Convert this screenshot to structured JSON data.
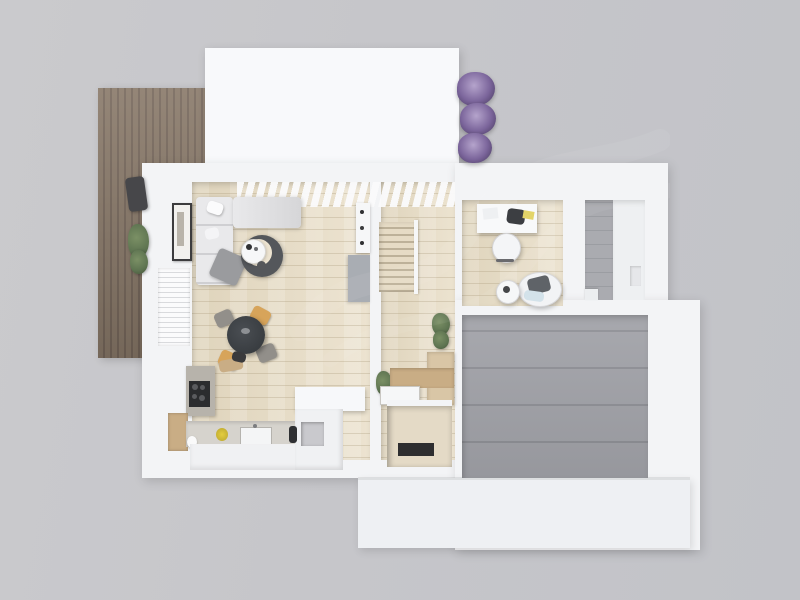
{
  "scene": {
    "title": "Top-down 3D floor plan render of a house",
    "view": "bird's-eye architectural visualization, no visible text or UI controls",
    "watermark": "faint diagonal light watermark across the center (illegible)",
    "rooms": [
      {
        "id": "deck",
        "label": "Wooden deck",
        "floor": "brown wood planks",
        "items": [
          "charcoal grill",
          "potted green plant"
        ]
      },
      {
        "id": "flat-roof",
        "label": "White flat roof section",
        "floor": "white",
        "items": []
      },
      {
        "id": "living-room",
        "label": "Open-plan living room",
        "floor": "light oak planks",
        "items": [
          "corner sofa with pillows",
          "grey throw blanket",
          "framed wall art",
          "dark round rug",
          "round coffee table",
          "dark side stool",
          "wall shelf with bottles",
          "grey concrete panel",
          "ceiling beam slats"
        ]
      },
      {
        "id": "dining-area",
        "label": "Dining area",
        "floor": "light oak planks",
        "items": [
          "round dark dining table",
          "tan chair",
          "tan chair",
          "grey chair",
          "grey chair"
        ]
      },
      {
        "id": "kitchen",
        "label": "Kitchen",
        "floor": "light oak planks",
        "items": [
          "steel counter with black cooktop",
          "cutting board",
          "low wooden cabinet",
          "sink counter with basin",
          "yellow flowers",
          "white kitchen island with open niche",
          "dark bottle",
          "base cabinets"
        ]
      },
      {
        "id": "hallway",
        "label": "Hallway with staircase",
        "floor": "light oak planks",
        "items": [
          "staircase",
          "stair rail",
          "potted plant",
          "light wood cabinet",
          "potted plant",
          "wooden vanity with white basin",
          "utility niche with dark appliance"
        ]
      },
      {
        "id": "office",
        "label": "Home office",
        "floor": "light oak planks",
        "items": [
          "white desk",
          "dark laptop",
          "papers",
          "yellow notepad",
          "white desk chair",
          "round lounge chair with dark cushion",
          "light blue blanket",
          "round side table"
        ]
      },
      {
        "id": "bathroom",
        "label": "Bathroom",
        "floor": "small grey tiles + white strip",
        "items": [
          "white step",
          "wall niche"
        ]
      },
      {
        "id": "garage",
        "label": "Garage / utility room",
        "floor": "large grey concrete tiles",
        "items": []
      },
      {
        "id": "lower-terrace",
        "label": "Lower white terrace slab",
        "floor": "white concrete",
        "items": []
      },
      {
        "id": "garden",
        "label": "Lavender shrubs along top wall",
        "floor": "",
        "items": [
          "lavender bush",
          "lavender bush",
          "lavender bush"
        ]
      }
    ]
  },
  "palette": {
    "bg_left": "#cacacd",
    "bg_right": "#c2c3c8",
    "wall": "#f3f4f6",
    "roof": "#f8f9fb",
    "terrace": "#eef0f3",
    "wood_light": "#ece3d0",
    "wood_dark": "#dfd4bc",
    "deck": "#887868",
    "deck_line": "#75665a",
    "tile": "#a0a1a7",
    "tile_grout": "#8d8e94",
    "bath_tile": "#aaabb0",
    "bath_grout": "#9b9da2",
    "sofa": "#e9e9eb",
    "sofa_dark": "#d6d6d8",
    "rug": "#54575b",
    "dining_table": "#393d41",
    "chair_tan": "#d7a45a",
    "chair_gray": "#928f8a",
    "plant_green": "#5e7451",
    "lavender": "#7b659b",
    "lavender_light": "#b5a4cc",
    "lavender_deep": "#4e3f66",
    "steel": "#b7b3ab",
    "cooktop": "#2b2c2e",
    "wood_cabinet": "#c9ad85",
    "island_white": "#f0f1f3",
    "gray_slab": "#a9adb3",
    "counter": "#d6d3cd"
  }
}
